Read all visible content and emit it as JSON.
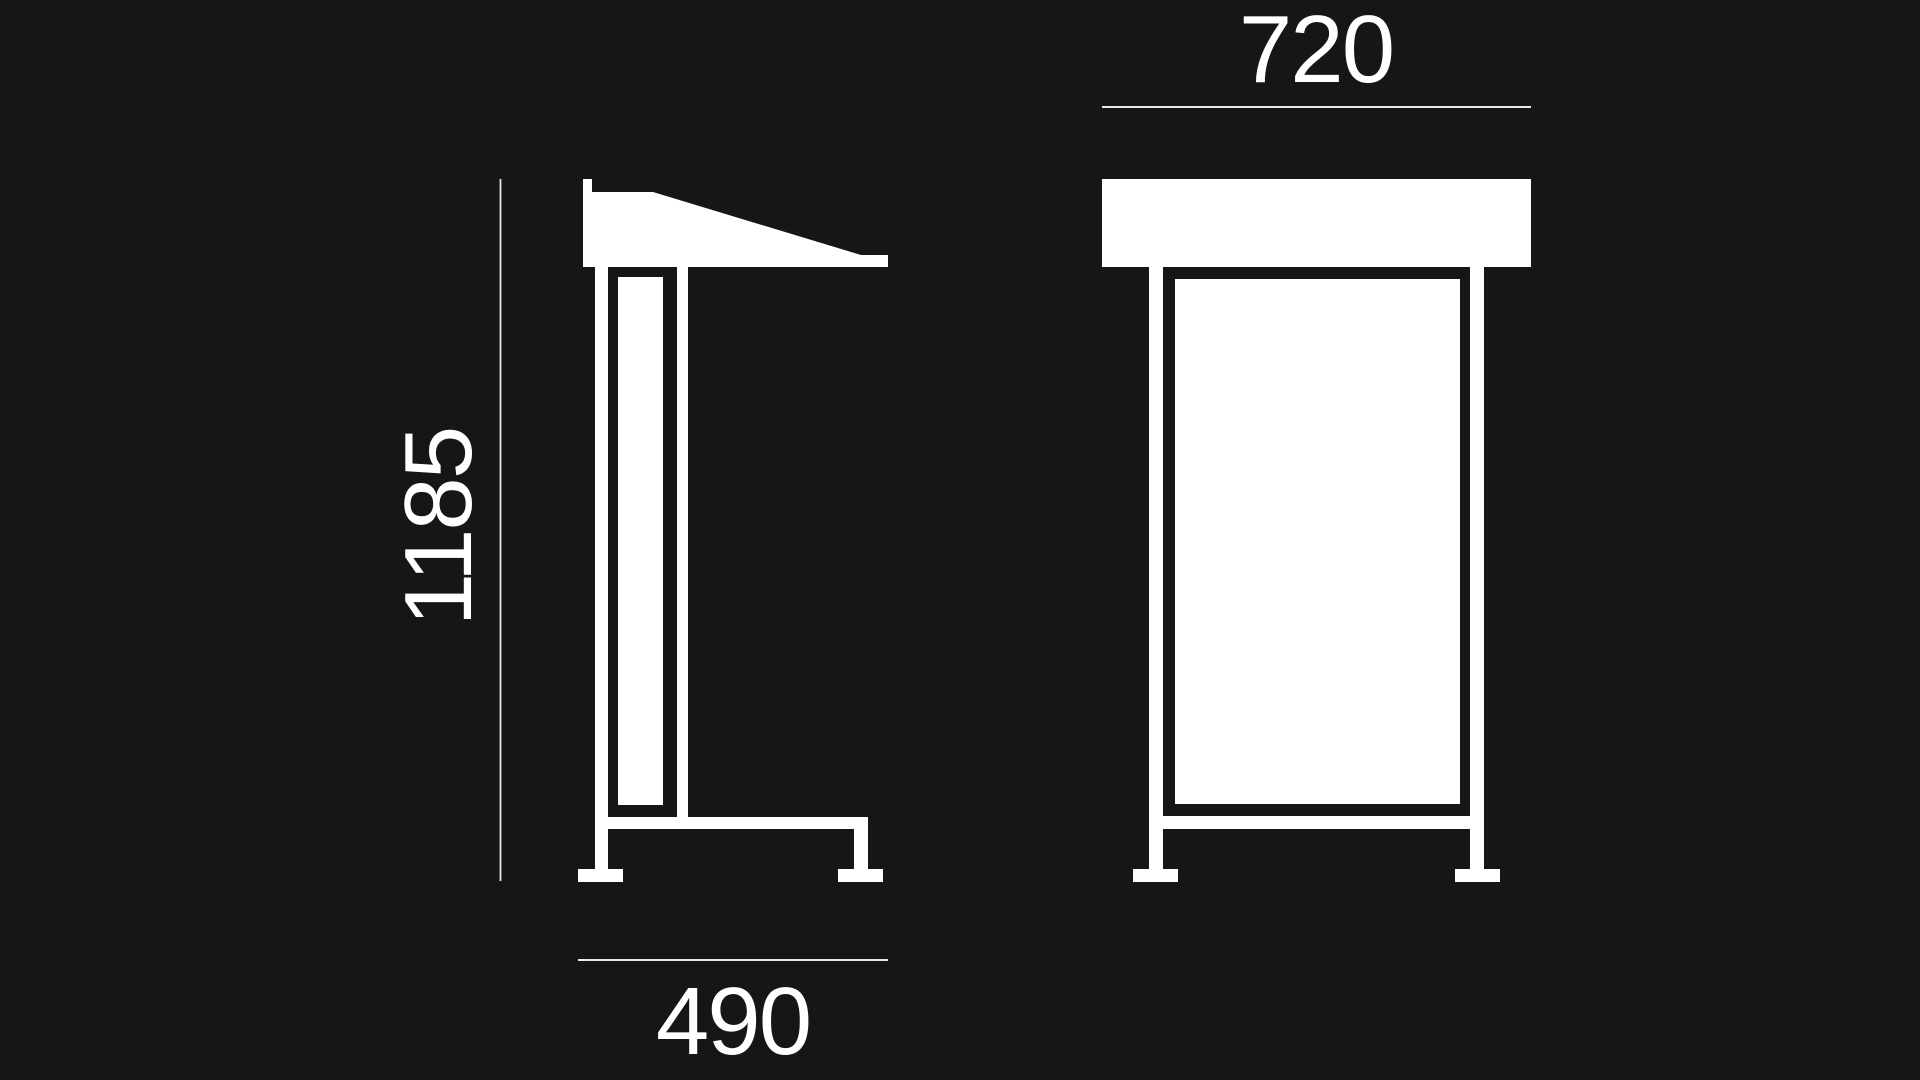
{
  "canvas": {
    "background_color": "#161616",
    "drawing_color": "#ffffff",
    "dimension_line_color": "#e8e8e8",
    "label_color": "#ffffff"
  },
  "dimensions": {
    "height": "1185",
    "depth": "490",
    "width": "720"
  }
}
